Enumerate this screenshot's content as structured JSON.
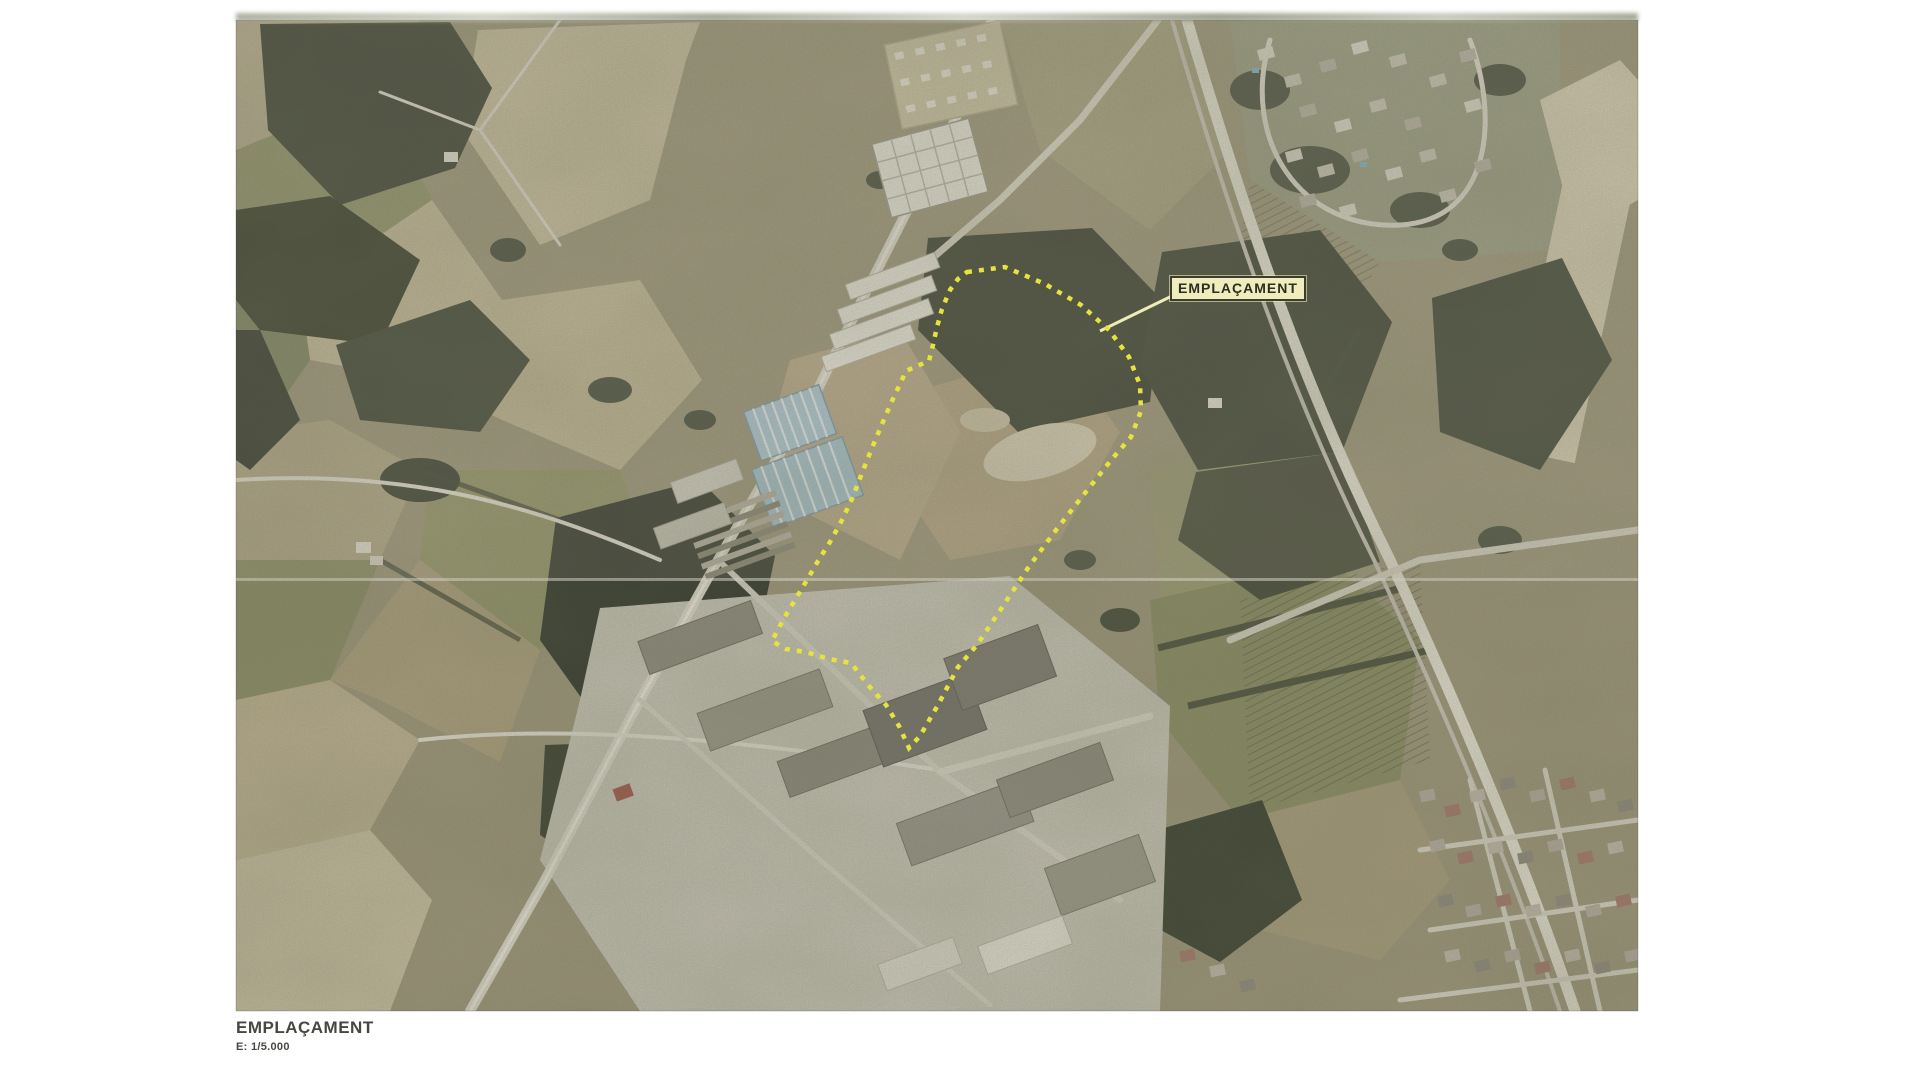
{
  "document": {
    "type": "scanned planning document page with aerial orthophoto",
    "background": "#ffffff"
  },
  "map": {
    "site_label": "EMPLAÇAMENT",
    "site_label_bg": "#efedbb",
    "site_label_border": "#3c3c32",
    "boundary_color": "#e7e33e",
    "boundary_style": "dotted",
    "scan_seam_y": 580,
    "photo_area": {
      "left": 236,
      "top": 20,
      "width": 1402,
      "height": 991
    }
  },
  "caption": {
    "title": "EMPLAÇAMENT",
    "scale": "E: 1/5.000"
  },
  "palette": {
    "field_tan": "#b9ac8c",
    "field_pale": "#cec4a6",
    "field_olive": "#8d9067",
    "forest_dark": "#383d2e",
    "road_light": "#dedacd",
    "highway_light": "#e6e2d4",
    "warehouse_blue": "#aec9d6",
    "warehouse_white": "#eceadf",
    "urban_roof_red": "#a4756a"
  }
}
